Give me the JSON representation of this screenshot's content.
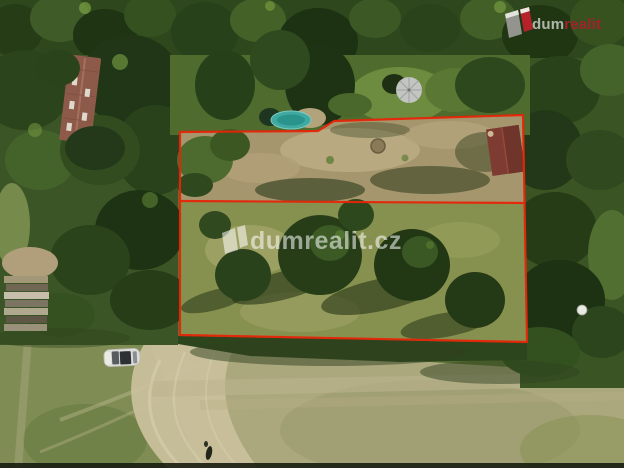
{
  "watermark": {
    "text": "dumrealit.cz",
    "fill": "rgba(255,255,255,0.55)"
  },
  "logo": {
    "text_light": "dum",
    "text_accent": "realit",
    "light_color": "rgba(230,230,228,0.72)",
    "accent_color": "#a2222b",
    "mark_grey": "#94948e",
    "mark_red": "#b5222a"
  },
  "boundary": {
    "color": "#e62508",
    "outer_points": "180,132 318,131 334,121 523,115 527,342 180,335",
    "divider_points": "180,201 525,203"
  },
  "objects": [
    {
      "name": "house-roof",
      "color": "#8d5a49"
    },
    {
      "name": "garden-shed-roof",
      "color": "#7e3b31"
    },
    {
      "name": "parked-car",
      "color": "#dcdcd8"
    },
    {
      "name": "garden-pool",
      "color": "#3fa9a2"
    },
    {
      "name": "parasol",
      "color": "#c2c5c2"
    },
    {
      "name": "wood-pile",
      "color": "#a29878"
    },
    {
      "name": "white-dish",
      "color": "#e9eae4"
    }
  ]
}
